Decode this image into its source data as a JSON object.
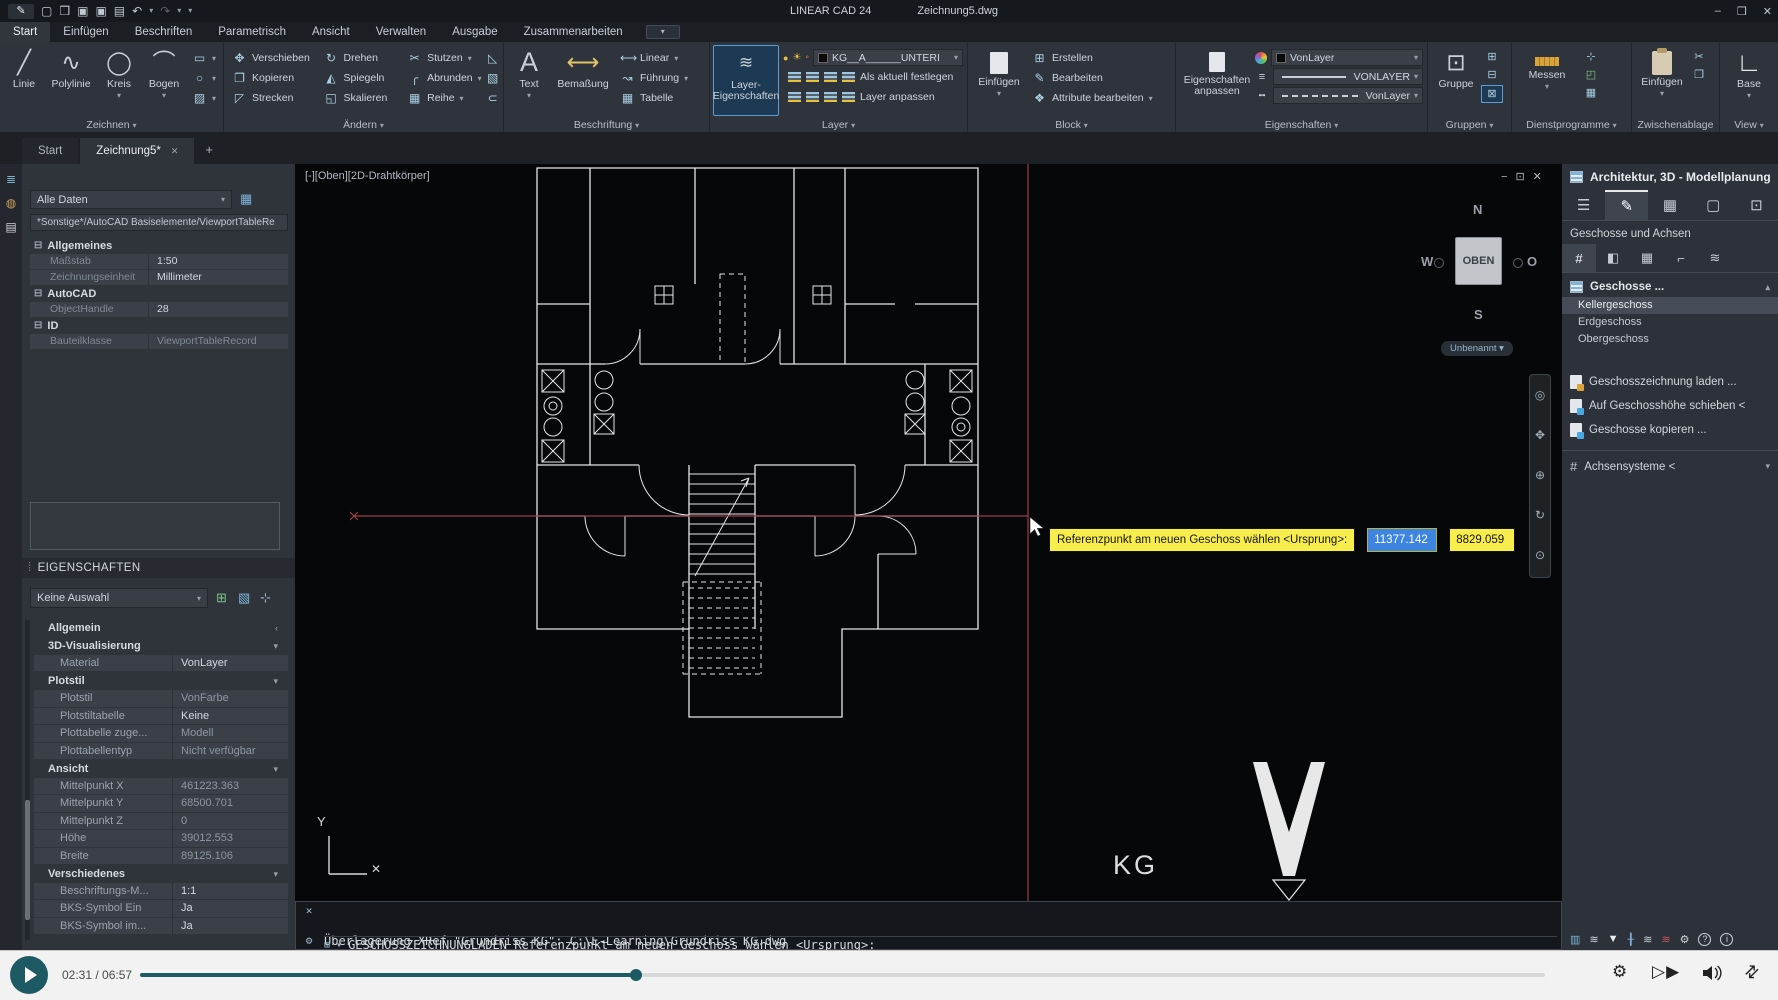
{
  "titlebar": {
    "app": "LINEAR CAD 24",
    "doc": "Zeichnung5.dwg",
    "min": "–",
    "max": "❒",
    "close": "✕"
  },
  "menu": {
    "items": [
      "Start",
      "Einfügen",
      "Beschriften",
      "Parametrisch",
      "Ansicht",
      "Verwalten",
      "Ausgabe",
      "Zusammenarbeiten"
    ]
  },
  "ribbon": {
    "zeichnen": {
      "label": "Zeichnen",
      "b1": "Linie",
      "b2": "Polylinie",
      "b3": "Kreis",
      "b4": "Bogen"
    },
    "aendern": {
      "label": "Ändern",
      "r1": "Verschieben",
      "r2": "Kopieren",
      "r3": "Strecken",
      "r4": "Drehen",
      "r5": "Spiegeln",
      "r6": "Skalieren",
      "r7": "Stutzen",
      "r8": "Abrunden",
      "r9": "Reihe"
    },
    "beschriftung": {
      "label": "Beschriftung",
      "b1": "Text",
      "b2": "Bemaßung",
      "s1": "Linear",
      "s2": "Führung",
      "s3": "Tabelle"
    },
    "layer": {
      "label": "Layer",
      "big": "Layer-Eigenschaften",
      "dropdown": "KG__A______UNTERI",
      "a1": "Als aktuell festlegen",
      "a2": "Layer anpassen"
    },
    "block": {
      "label": "Block",
      "big": "Einfügen",
      "s1": "Erstellen",
      "s2": "Bearbeiten",
      "s3": "Attribute bearbeiten"
    },
    "eigenschaften": {
      "label": "Eigenschaften",
      "big": "Eigenschaften anpassen",
      "color": "VonLayer",
      "lineweight": "VONLAYER",
      "linetype": "VonLayer"
    },
    "gruppen": {
      "label": "Gruppen",
      "big": "Gruppe"
    },
    "dienstprogramme": {
      "label": "Dienstprogramme",
      "big": "Messen"
    },
    "zwischenablage": {
      "label": "Zwischenablage",
      "big": "Einfügen"
    },
    "view": {
      "label": "View",
      "big": "Base"
    }
  },
  "doc_tabs": {
    "t1": "Start",
    "t2": "Zeichnung5*",
    "close": "✕",
    "add": "+"
  },
  "data_panel": {
    "filter": "Alle Daten",
    "path": "*Sonstige*/AutoCAD Basiselemente/ViewportTableRe",
    "h1": "Allgemeines",
    "r1k": "Maßstab",
    "r1v": "1:50",
    "r2k": "Zeichnungseinheit",
    "r2v": "Millimeter",
    "h2": "AutoCAD",
    "r3k": "ObjectHandle",
    "r3v": "28",
    "h3": "ID",
    "r4k": "Bauteilklasse",
    "r4v": "ViewportTableRecord"
  },
  "properties": {
    "title": "EIGENSCHAFTEN",
    "selection": "Keine Auswahl",
    "h_allgemein": "Allgemein",
    "h_3d": "3D-Visualisierung",
    "m_k": "Material",
    "m_v": "VonLayer",
    "h_plotstil": "Plotstil",
    "p1k": "Plotstil",
    "p1v": "VonFarbe",
    "p2k": "Plotstiltabelle",
    "p2v": "Keine",
    "p3k": "Plottabelle zuge...",
    "p3v": "Modell",
    "p4k": "Plottabellentyp",
    "p4v": "Nicht verfügbar",
    "h_ansicht": "Ansicht",
    "a1k": "Mittelpunkt X",
    "a1v": "461223.363",
    "a2k": "Mittelpunkt Y",
    "a2v": "68500.701",
    "a3k": "Mittelpunkt Z",
    "a3v": "0",
    "a4k": "Höhe",
    "a4v": "39012.553",
    "a5k": "Breite",
    "a5v": "89125.106",
    "h_versch": "Verschiedenes",
    "v1k": "Beschriftungs-M...",
    "v1v": "1:1",
    "v2k": "BKS-Symbol Ein",
    "v2v": "Ja",
    "v3k": "BKS-Symbol im...",
    "v3v": "Ja"
  },
  "viewport": {
    "label": "[-][Oben][2D-Drahtkörper]",
    "win_min": "−",
    "win_max": "⊡",
    "win_close": "✕",
    "compass": {
      "n": "N",
      "w": "W",
      "o": "O",
      "s": "S",
      "cube": "OBEN",
      "pill": "Unbenannt ▾"
    },
    "tooltip": {
      "text": "Referenzpunkt am neuen Geschoss wählen <Ursprung>:",
      "x": "11377.142",
      "y": "8829.059"
    },
    "plan_label": "KG",
    "axis_y": "Y",
    "axis_x_marker": "✕"
  },
  "command": {
    "line1": "Überlagerung XRef \"Grundriss KG\": C:\\E-Learning\\Grundriss KG.dwg",
    "line2": "\"Grundriss KG\" geladen.",
    "prompt": "GESCHOSSZEICHNUNGLADEN Referenzpunkt am neuen Geschoss wählen <Ursprung>:"
  },
  "right_panel": {
    "title": "Architektur, 3D - Modellplanung",
    "section": "Geschosse und Achsen",
    "geschosse": "Geschosse ...",
    "floor1": "Kellergeschoss",
    "floor2": "Erdgeschoss",
    "floor3": "Obergeschoss",
    "btn1": "Geschosszeichnung laden ...",
    "btn2": "Auf Geschosshöhe schieben <",
    "btn3": "Geschosse kopieren ...",
    "achsen": "Achsensysteme <"
  },
  "player": {
    "time": "02:31 / 06:57"
  },
  "icons": {
    "caret": "▾",
    "caret_up": "▴",
    "chev_left": "‹",
    "minus_box": "⊟",
    "line": "╱",
    "polyline": "∿",
    "circle": "◯",
    "arc": "⌒",
    "rect": "▭",
    "ellipse": "○",
    "hatch": "▨",
    "move": "✥",
    "rotate": "↻",
    "trim": "✂",
    "copy": "❐",
    "mirror": "◭",
    "fillet": "╭",
    "stretch": "◸",
    "scale": "◱",
    "array": "▦",
    "erase": "◺",
    "box": "▧",
    "lasso": "⊂",
    "textA": "A",
    "dim": "⟷",
    "linear": "⟷",
    "leader": "↝",
    "table": "▦",
    "create": "⊞",
    "edit": "✎",
    "attr": "❖",
    "sun": "☀",
    "bulb": "●",
    "lock": "◦",
    "gruppe": "⊡",
    "g1": "⊞",
    "g2": "⊟",
    "g3": "⊠",
    "pick": "⊹",
    "calc": "▦",
    "box2": "◰",
    "cut": "✂",
    "paste_copy": "❐",
    "base": "∟",
    "undo": "↶",
    "redo": "↷",
    "new": "▢",
    "open": "❒",
    "save": "▣",
    "saveas": "▣",
    "print": "▤",
    "strip1": "≣",
    "strip2": "◍",
    "strip3": "▤",
    "tbl_small": "▦",
    "sel_add": "⊞",
    "sel_box": "▧",
    "rp_menu": "☰",
    "rp_pencil": "✎",
    "rp_calc": "▦",
    "rp_page": "▢",
    "rp_pick": "⊡",
    "rp_axes": "#",
    "rp_wall": "◧",
    "rp_window": "▦",
    "rp_pipe": "⌐",
    "rp_layers": "≋",
    "nav": "◎\n✥\n⊕\n↻\n⊙",
    "s1": "▥",
    "s2": "≋",
    "s3": "▼",
    "s4": "╂",
    "s5": "≋",
    "s6": "≋",
    "s7": "⚙",
    "s8": "?",
    "s9": "i",
    "cmd_close": "✕",
    "cmd_tool": "⚙",
    "cmd_box": "⊞",
    "gear": "⚙",
    "speed": "▷▶",
    "shrink": "⇄"
  },
  "colors": {
    "accent_teal": "#1e5a64",
    "tooltip_yellow": "#f7ee4e",
    "selection_blue": "#3d85e0",
    "crosshair_red": "#9c3e45",
    "ribbon_highlight": "#5e9bd3"
  }
}
